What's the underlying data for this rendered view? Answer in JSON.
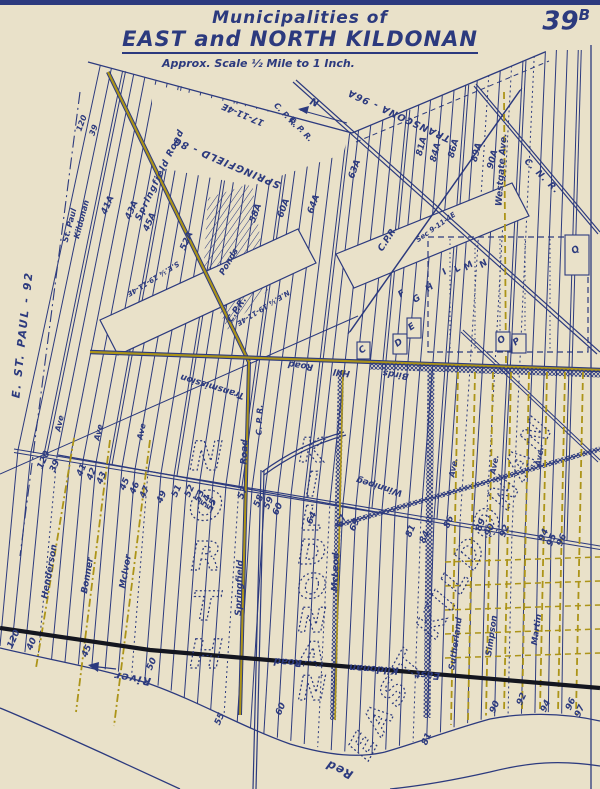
{
  "header": {
    "title_line1": "Municipalities of",
    "title_line2": "EAST and NORTH KILDONAN",
    "scale_note": "Approx. Scale ½ Mile to 1 Inch.",
    "sheet_number_main": "39",
    "sheet_number_suffix": "B"
  },
  "map": {
    "colors": {
      "paper": "#e9e1c9",
      "ink": "#2c3a7e",
      "olive": "#ac9418",
      "dark_road": "#14161f"
    },
    "labels": [
      [
        "E. ST. PAUL - 92",
        26,
        335,
        -84,
        11,
        2
      ],
      [
        "St. Paul",
        72,
        226,
        -75,
        8,
        0
      ],
      [
        "Kildonan",
        84,
        220,
        -75,
        8,
        0
      ],
      [
        "SPRINGFIELD - 80",
        228,
        160,
        203,
        10,
        1
      ],
      [
        "17-11-4E",
        244,
        112,
        203,
        9,
        0
      ],
      [
        "TRANSCONA - 96A",
        400,
        113,
        205,
        9.5,
        1
      ],
      [
        "N",
        316,
        99,
        205,
        10,
        0
      ],
      [
        "C. P. R.",
        284,
        117,
        47,
        8,
        0
      ],
      [
        "C. P. R.",
        299,
        131,
        47,
        8,
        0
      ],
      [
        "C. N. R.",
        540,
        178,
        45,
        9,
        1
      ],
      [
        "C.P.R.",
        239,
        311,
        -57,
        9,
        0
      ],
      [
        "C.P.R.",
        390,
        240,
        -57,
        9,
        0
      ],
      [
        "C. P. R.",
        262,
        420,
        -88,
        8,
        0
      ],
      [
        "Ponds",
        231,
        263,
        -60,
        8.5,
        0
      ],
      [
        "Transmission",
        213,
        384,
        197,
        9,
        0
      ],
      [
        "Winnipeg",
        380,
        484,
        197,
        9,
        0
      ],
      [
        "S.E.¼ 19-11-4E",
        152,
        277,
        148,
        7,
        0
      ],
      [
        "N.E.¼ 19-11-4E",
        262,
        306,
        148,
        7,
        0
      ],
      [
        "Sec 9-11-4E",
        437,
        229,
        -35,
        7,
        0
      ],
      [
        "Springfield Road",
        162,
        176,
        -64,
        9,
        1
      ],
      [
        "Road",
        247,
        452,
        -88,
        9,
        0
      ],
      [
        "Springfield",
        242,
        588,
        -88,
        9,
        0
      ],
      [
        "Birds",
        396,
        372,
        188,
        9,
        0
      ],
      [
        "Hill",
        342,
        370,
        188,
        9,
        0
      ],
      [
        "Road",
        301,
        363,
        188,
        9,
        0
      ],
      [
        "Road",
        288,
        659,
        184,
        10,
        0
      ],
      [
        "Kildonan",
        374,
        666,
        184,
        10,
        0
      ],
      [
        "East",
        428,
        672,
        184,
        10,
        0
      ],
      [
        "McLeod",
        338,
        572,
        -88,
        9,
        0
      ],
      [
        "Henderson",
        52,
        572,
        -80,
        9,
        0
      ],
      [
        "Bonner",
        90,
        576,
        -80,
        9,
        0
      ],
      [
        "McIvor",
        128,
        572,
        -80,
        9,
        0
      ],
      [
        "Sutherland",
        458,
        644,
        -82,
        8.5,
        0
      ],
      [
        "Simpson",
        494,
        636,
        -82,
        8.5,
        0
      ],
      [
        "Martin",
        539,
        630,
        -82,
        8.5,
        0
      ],
      [
        "Westgate Ave.",
        504,
        170,
        -86,
        9,
        0
      ],
      [
        "Ave",
        62,
        424,
        -78,
        8,
        0
      ],
      [
        "Ave",
        101,
        433,
        -78,
        8,
        0
      ],
      [
        "Ave",
        144,
        432,
        -78,
        8,
        0
      ],
      [
        "Ave.",
        456,
        468,
        -80,
        8,
        0
      ],
      [
        "Ave.",
        497,
        465,
        -80,
        8,
        0
      ],
      [
        "Ave.",
        542,
        457,
        -80,
        8,
        0
      ],
      [
        "River",
        133,
        675,
        190,
        11,
        1
      ],
      [
        "Red",
        341,
        766,
        205,
        12,
        1
      ],
      [
        "120",
        84,
        124,
        -70,
        8,
        0
      ],
      [
        "39",
        96,
        131,
        -70,
        8,
        0
      ],
      [
        "41A",
        110,
        206,
        -66,
        9,
        0
      ],
      [
        "43A",
        134,
        211,
        -66,
        9,
        0
      ],
      [
        "45A",
        152,
        223,
        -66,
        9,
        0
      ],
      [
        "52A",
        189,
        242,
        -66,
        9,
        0
      ],
      [
        "58A",
        258,
        214,
        -70,
        9,
        0
      ],
      [
        "60A",
        286,
        209,
        -70,
        9,
        0
      ],
      [
        "64A",
        316,
        205,
        -70,
        9,
        0
      ],
      [
        "63A",
        357,
        170,
        -70,
        9,
        0
      ],
      [
        "81A",
        424,
        147,
        -75,
        9,
        0
      ],
      [
        "84A",
        438,
        153,
        -75,
        9,
        0
      ],
      [
        "86A",
        456,
        149,
        -75,
        9,
        0
      ],
      [
        "89A",
        479,
        153,
        -75,
        9,
        0
      ],
      [
        "90A",
        495,
        160,
        -75,
        9,
        0
      ],
      [
        "120",
        46,
        461,
        -66,
        9,
        0
      ],
      [
        "39",
        57,
        467,
        -66,
        9,
        0
      ],
      [
        "41",
        84,
        471,
        -66,
        9,
        0
      ],
      [
        "42",
        94,
        475,
        -66,
        9,
        0
      ],
      [
        "43",
        104,
        479,
        -66,
        9,
        0
      ],
      [
        "45",
        127,
        485,
        -66,
        9,
        0
      ],
      [
        "46",
        137,
        489,
        -66,
        9,
        0
      ],
      [
        "47",
        147,
        493,
        -66,
        9,
        0
      ],
      [
        "49",
        164,
        498,
        -66,
        9,
        0
      ],
      [
        "51",
        179,
        492,
        -66,
        9,
        0
      ],
      [
        "52",
        192,
        492,
        -66,
        9,
        0
      ],
      [
        "53",
        202,
        497,
        -66,
        9,
        0
      ],
      [
        "54",
        208,
        502,
        -66,
        9,
        0
      ],
      [
        "55",
        214,
        506,
        -66,
        9,
        0
      ],
      [
        "57",
        245,
        494,
        -66,
        9,
        0
      ],
      [
        "58",
        261,
        502,
        -66,
        9,
        0
      ],
      [
        "59",
        271,
        504,
        -66,
        9,
        0
      ],
      [
        "60",
        280,
        510,
        -66,
        9,
        0
      ],
      [
        "64",
        314,
        519,
        -66,
        9,
        0
      ],
      [
        "67",
        344,
        522,
        -66,
        9,
        0
      ],
      [
        "69",
        357,
        526,
        -66,
        9,
        0
      ],
      [
        "81",
        413,
        532,
        -66,
        9,
        0
      ],
      [
        "84",
        427,
        538,
        -66,
        9,
        0
      ],
      [
        "86",
        451,
        523,
        -66,
        9,
        0
      ],
      [
        "89",
        483,
        526,
        -66,
        9,
        0
      ],
      [
        "90",
        492,
        531,
        -66,
        9,
        0
      ],
      [
        "92",
        507,
        532,
        -66,
        9,
        0
      ],
      [
        "94",
        546,
        536,
        -66,
        9,
        0
      ],
      [
        "95",
        554,
        541,
        -66,
        9,
        0
      ],
      [
        "96",
        564,
        541,
        -66,
        9,
        0
      ],
      [
        "120",
        16,
        640,
        -66,
        9,
        0
      ],
      [
        "40",
        34,
        645,
        -66,
        9,
        0
      ],
      [
        "45",
        89,
        652,
        -66,
        9,
        0
      ],
      [
        "50",
        154,
        665,
        -66,
        9,
        0
      ],
      [
        "55",
        222,
        720,
        -66,
        9,
        0
      ],
      [
        "60",
        283,
        710,
        -66,
        9,
        0
      ],
      [
        "81",
        429,
        740,
        -66,
        9,
        0
      ],
      [
        "90",
        497,
        708,
        -66,
        9,
        0
      ],
      [
        "92",
        524,
        700,
        -66,
        9,
        0
      ],
      [
        "94",
        548,
        707,
        -66,
        9,
        0
      ],
      [
        "96",
        573,
        705,
        -66,
        9,
        0
      ],
      [
        "97",
        582,
        712,
        -66,
        9,
        0
      ],
      [
        "C",
        364,
        352,
        -35,
        9,
        0
      ],
      [
        "D",
        400,
        345,
        -35,
        9,
        0
      ],
      [
        "E",
        413,
        329,
        -35,
        9,
        0
      ],
      [
        "F",
        403,
        296,
        -35,
        9,
        0
      ],
      [
        "G",
        418,
        301,
        -35,
        9,
        0
      ],
      [
        "H",
        431,
        290,
        -35,
        9,
        0
      ],
      [
        "I",
        446,
        274,
        -35,
        9,
        0
      ],
      [
        "L",
        459,
        271,
        -35,
        9,
        0
      ],
      [
        "M",
        470,
        268,
        -35,
        9,
        0
      ],
      [
        "N",
        485,
        266,
        -35,
        9,
        0
      ],
      [
        "O",
        503,
        342,
        -35,
        9,
        0
      ],
      [
        "P",
        518,
        344,
        -35,
        9,
        0
      ],
      [
        "Q",
        577,
        252,
        -35,
        9,
        0
      ]
    ],
    "big_labels": [
      [
        "N",
        206,
        470,
        0,
        40,
        0
      ],
      [
        "O",
        206,
        520,
        0,
        40,
        0
      ],
      [
        "R",
        206,
        570,
        0,
        40,
        0
      ],
      [
        "T",
        206,
        620,
        0,
        40,
        0
      ],
      [
        "H",
        206,
        668,
        0,
        40,
        0
      ],
      [
        "K",
        312,
        462,
        0,
        34,
        0
      ],
      [
        "I",
        312,
        496,
        0,
        34,
        0
      ],
      [
        "L",
        312,
        530,
        0,
        34,
        0
      ],
      [
        "D",
        312,
        564,
        0,
        34,
        0
      ],
      [
        "O",
        312,
        598,
        0,
        34,
        0
      ],
      [
        "N",
        312,
        632,
        0,
        34,
        0
      ],
      [
        "A",
        312,
        666,
        0,
        34,
        0
      ],
      [
        "N",
        312,
        700,
        0,
        34,
        0
      ],
      [
        "EAST KILDONAN",
        462,
        592,
        -61,
        34,
        6
      ]
    ]
  }
}
